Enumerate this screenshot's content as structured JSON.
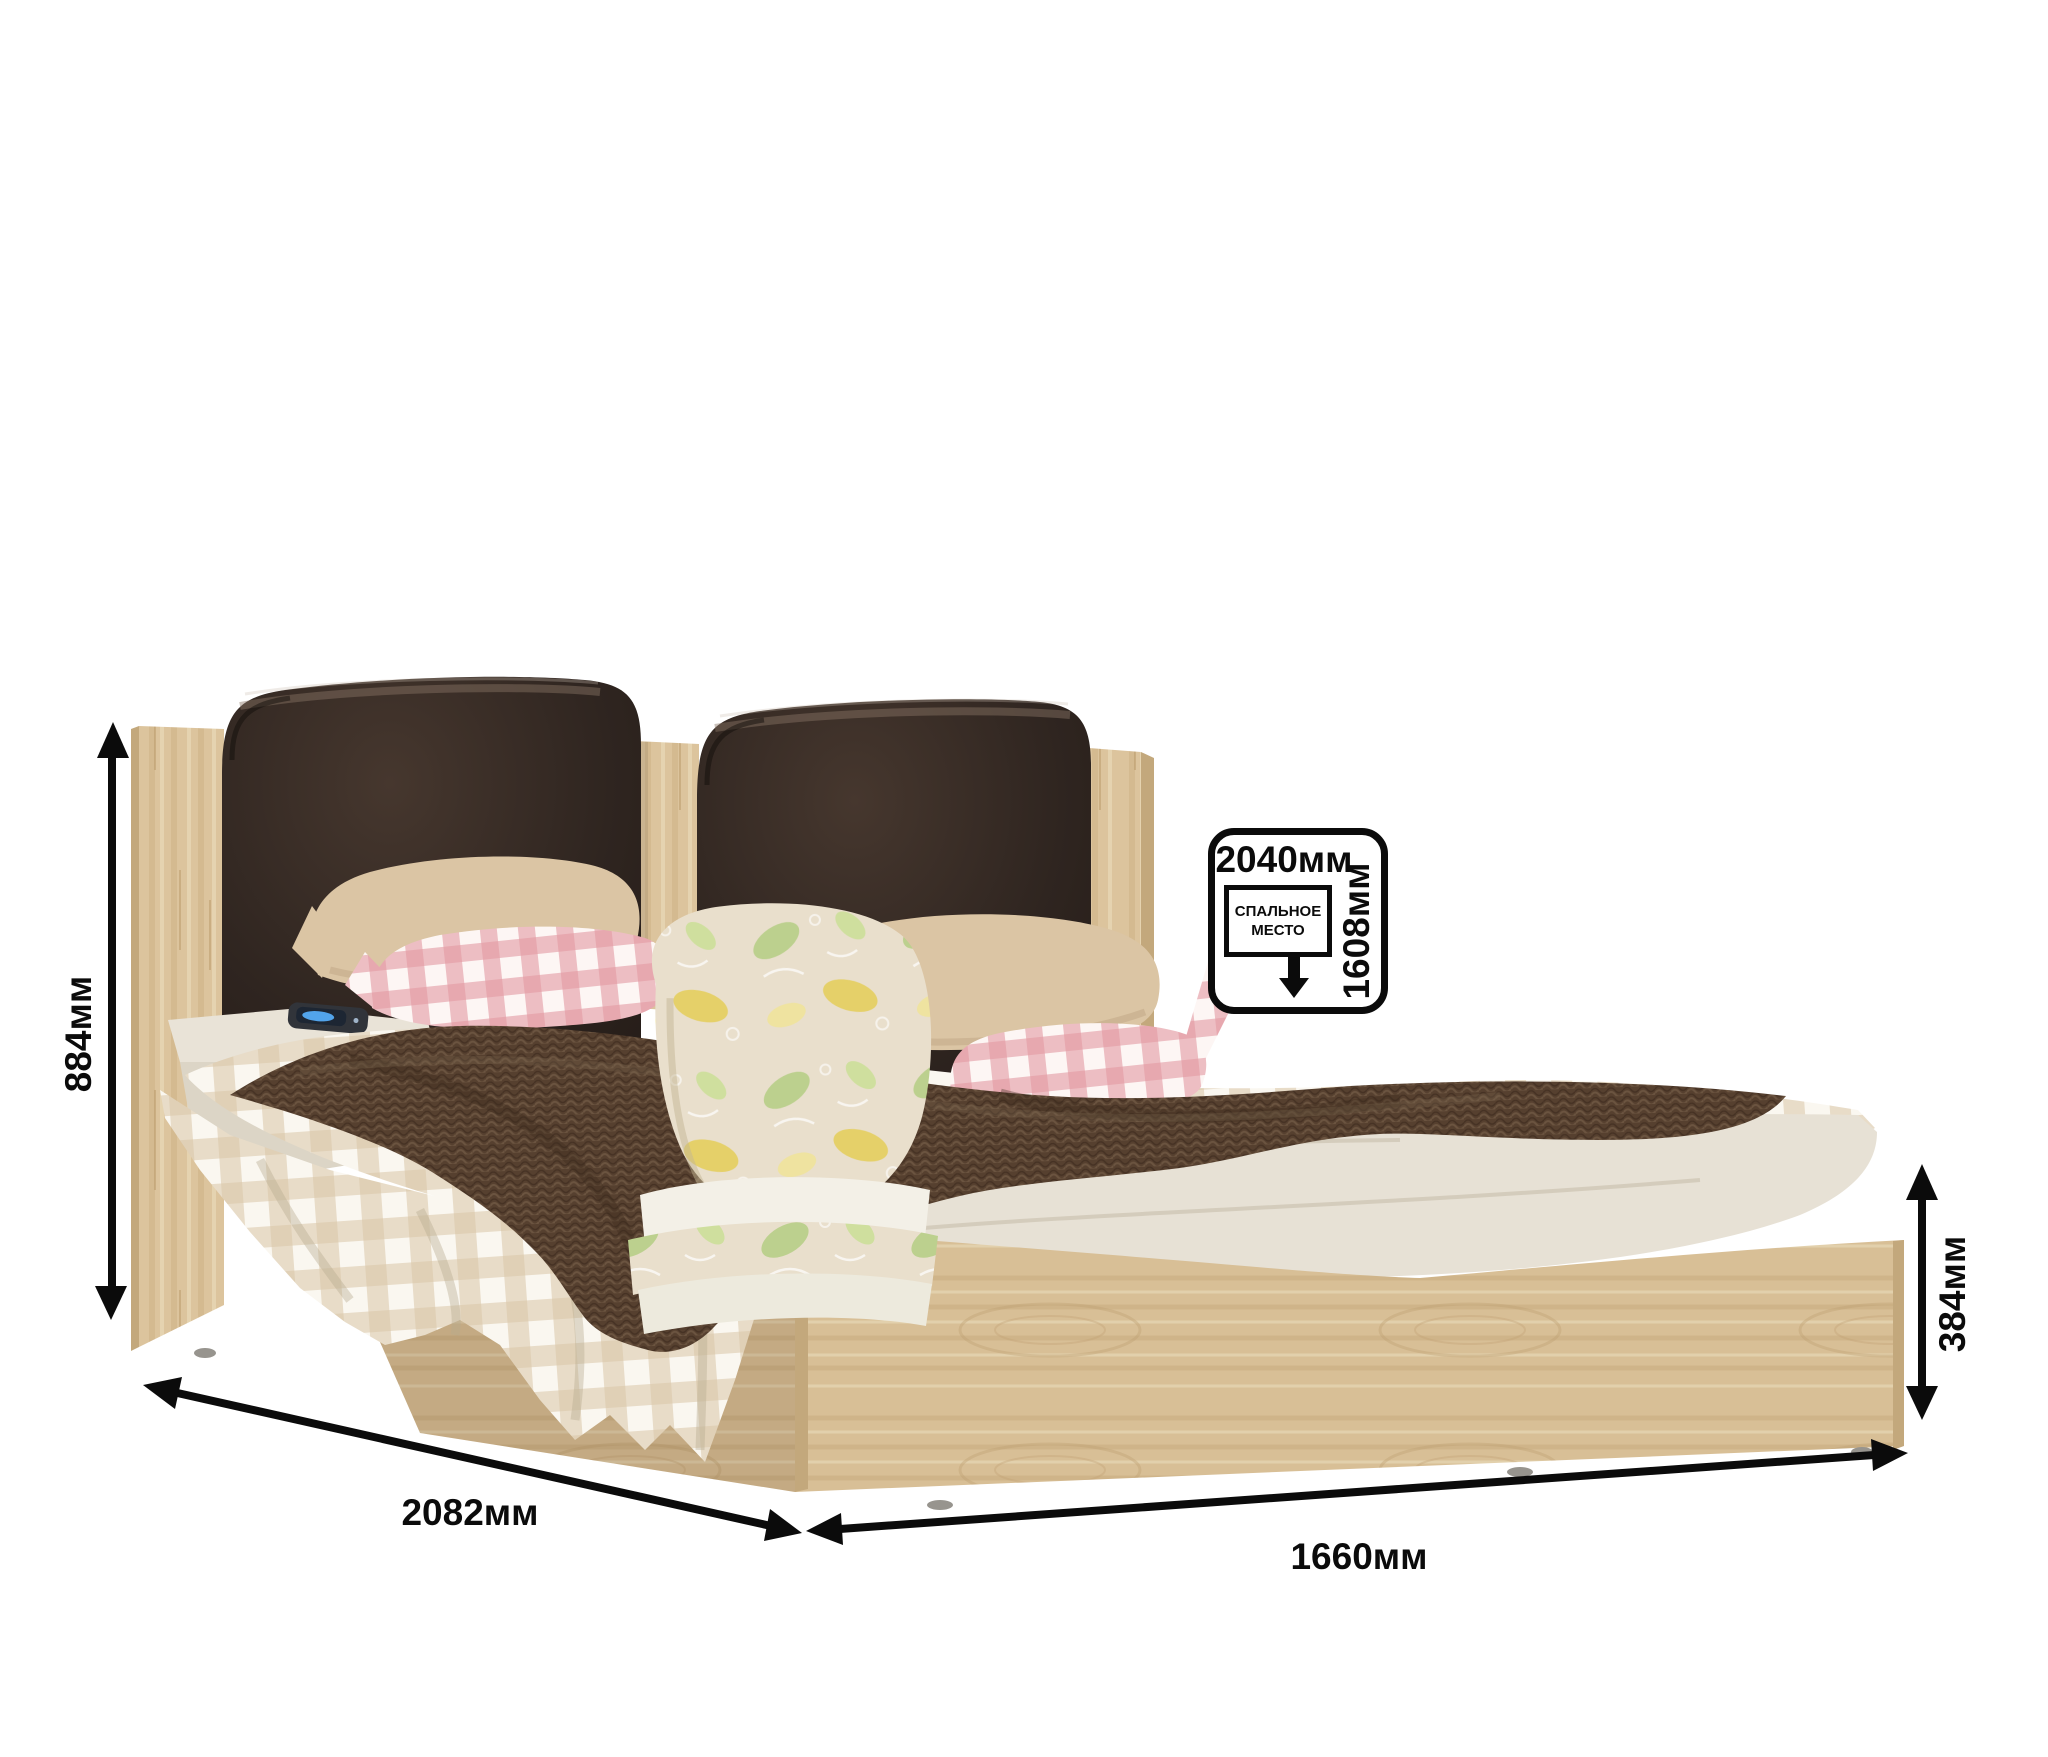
{
  "dimension_labels": {
    "headboard_height": "884мм",
    "length_diagonal": "2082мм",
    "front_width": "1660мм",
    "footboard_height": "384мм"
  },
  "sleeping_area_badge": {
    "length": "2040мм",
    "width": "1608мм",
    "caption_line1": "СПАЛЬНОЕ",
    "caption_line2": "МЕСТО",
    "arrow_icon": "down-arrow"
  },
  "colors": {
    "background": "#ffffff",
    "annotation": "#0b0b0b",
    "badge_background": "#ffffff",
    "oak": "#d9c098",
    "oak_edge": "#c3a87c",
    "leather": "#2e241e",
    "blanket": "#5b4231",
    "pillow_beige": "#dbc5a4",
    "gingham_beige": "#d9c6a7",
    "gingham_pink": "#e39aa2",
    "sheet": "#e7e1d5",
    "floral_base": "#e9dfcc"
  }
}
